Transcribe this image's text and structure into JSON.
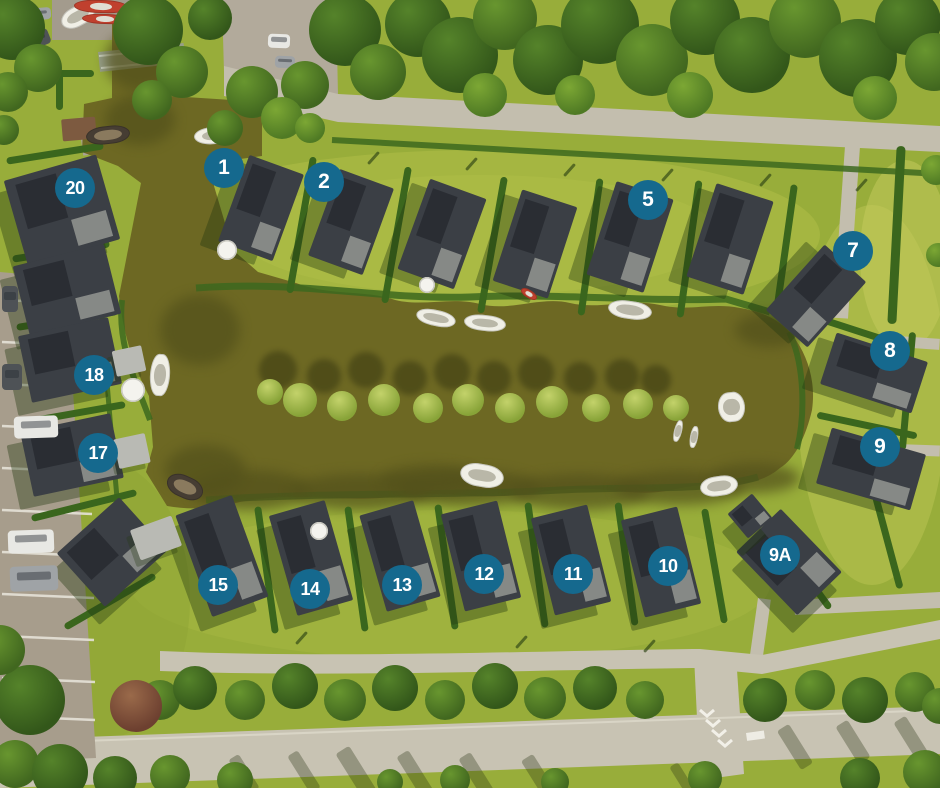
{
  "colors": {
    "marker_bg": "#15698e",
    "marker_text": "#ffffff",
    "water": "#6d6823",
    "grass": "#98ad3a",
    "road": "#c3beae",
    "road_light": "#c8c3b3",
    "parking": "#a79d8c",
    "roof": "#3b3f45",
    "roof_panel": "#2a2d33",
    "roof_light": "#8f918d",
    "hedge": "#3a661d",
    "boat_white": "#f0efe6",
    "shadow_olive": "#53511b"
  },
  "markers": [
    {
      "label": "1",
      "x": 224,
      "y": 168
    },
    {
      "label": "2",
      "x": 324,
      "y": 182
    },
    {
      "label": "5",
      "x": 648,
      "y": 200
    },
    {
      "label": "7",
      "x": 853,
      "y": 251
    },
    {
      "label": "8",
      "x": 890,
      "y": 351
    },
    {
      "label": "9",
      "x": 880,
      "y": 447
    },
    {
      "label": "9A",
      "x": 780,
      "y": 555
    },
    {
      "label": "10",
      "x": 668,
      "y": 566
    },
    {
      "label": "11",
      "x": 573,
      "y": 574
    },
    {
      "label": "12",
      "x": 484,
      "y": 574
    },
    {
      "label": "13",
      "x": 402,
      "y": 585
    },
    {
      "label": "14",
      "x": 310,
      "y": 589
    },
    {
      "label": "15",
      "x": 218,
      "y": 585
    },
    {
      "label": "17",
      "x": 98,
      "y": 453
    },
    {
      "label": "18",
      "x": 94,
      "y": 375
    },
    {
      "label": "20",
      "x": 75,
      "y": 188
    }
  ],
  "scene": {
    "houses": [
      [
        232,
        162,
        58,
        92,
        20
      ],
      [
        322,
        176,
        58,
        92,
        20
      ],
      [
        412,
        186,
        60,
        96,
        20
      ],
      [
        506,
        196,
        58,
        96,
        18
      ],
      [
        600,
        188,
        60,
        98,
        18
      ],
      [
        700,
        190,
        60,
        98,
        18
      ],
      [
        788,
        252,
        56,
        88,
        42
      ],
      [
        826,
        346,
        96,
        54,
        18
      ],
      [
        822,
        440,
        98,
        58,
        16
      ],
      [
        758,
        518,
        62,
        88,
        -44
      ],
      [
        734,
        500,
        32,
        32,
        -40
      ],
      [
        632,
        512,
        58,
        100,
        -14
      ],
      [
        542,
        510,
        58,
        100,
        -14
      ],
      [
        452,
        506,
        58,
        100,
        -14
      ],
      [
        372,
        506,
        56,
        100,
        -16
      ],
      [
        282,
        506,
        58,
        104,
        -16
      ],
      [
        192,
        502,
        60,
        108,
        -20
      ],
      [
        14,
        166,
        96,
        88,
        -16
      ],
      [
        20,
        254,
        94,
        72,
        -14
      ],
      [
        24,
        326,
        92,
        68,
        -12
      ],
      [
        26,
        422,
        92,
        66,
        -12
      ],
      [
        70,
        516,
        84,
        72,
        -42
      ]
    ],
    "sheds": [
      [
        116,
        436,
        32,
        30,
        -12
      ],
      [
        114,
        348,
        30,
        26,
        -12
      ],
      [
        134,
        522,
        44,
        32,
        -20
      ],
      [
        62,
        118,
        34,
        22,
        -5,
        "garden"
      ]
    ],
    "hedges": [
      [
        298,
        156,
        7,
        138,
        10
      ],
      [
        393,
        166,
        7,
        138,
        10
      ],
      [
        489,
        176,
        7,
        138,
        10
      ],
      [
        587,
        178,
        7,
        138,
        8
      ],
      [
        686,
        180,
        7,
        138,
        8
      ],
      [
        782,
        184,
        7,
        128,
        8
      ],
      [
        263,
        506,
        7,
        128,
        -8
      ],
      [
        353,
        506,
        7,
        126,
        -8
      ],
      [
        443,
        504,
        7,
        126,
        -8
      ],
      [
        533,
        502,
        7,
        126,
        -8
      ],
      [
        623,
        502,
        7,
        124,
        -8
      ],
      [
        711,
        508,
        7,
        116,
        -10
      ],
      [
        797,
        518,
        7,
        100,
        -36
      ],
      [
        6,
        150,
        98,
        7,
        -9
      ],
      [
        12,
        248,
        98,
        7,
        -9
      ],
      [
        16,
        316,
        102,
        7,
        -9
      ],
      [
        22,
        410,
        104,
        7,
        -10
      ],
      [
        30,
        502,
        108,
        7,
        -14
      ],
      [
        58,
        598,
        104,
        7,
        -30
      ],
      [
        810,
        328,
        98,
        7,
        18
      ],
      [
        816,
        422,
        102,
        7,
        12
      ],
      [
        892,
        146,
        9,
        178,
        3
      ],
      [
        904,
        332,
        7,
        118,
        5
      ],
      [
        884,
        492,
        7,
        98,
        -15
      ],
      [
        56,
        70,
        38,
        7,
        0
      ],
      [
        56,
        70,
        7,
        40,
        0
      ]
    ],
    "lamps": [
      [
        372,
        150,
        3,
        16,
        42
      ],
      [
        470,
        156,
        3,
        16,
        42
      ],
      [
        568,
        162,
        3,
        16,
        42
      ],
      [
        666,
        167,
        3,
        16,
        42
      ],
      [
        764,
        172,
        3,
        16,
        42
      ],
      [
        860,
        177,
        3,
        16,
        42
      ],
      [
        300,
        630,
        3,
        16,
        42
      ],
      [
        520,
        634,
        3,
        16,
        42
      ],
      [
        648,
        638,
        3,
        16,
        42
      ]
    ],
    "road_shadows": [
      [
        348,
        746,
        16,
        52,
        -32
      ],
      [
        408,
        750,
        14,
        48,
        -32
      ],
      [
        470,
        752,
        14,
        48,
        -32
      ],
      [
        532,
        754,
        14,
        46,
        -32
      ],
      [
        298,
        750,
        12,
        44,
        -32
      ],
      [
        788,
        724,
        14,
        46,
        -32
      ],
      [
        846,
        720,
        14,
        44,
        -32
      ],
      [
        904,
        716,
        14,
        44,
        -32
      ],
      [
        238,
        754,
        12,
        40,
        -32
      ],
      [
        678,
        762,
        10,
        36,
        -32
      ]
    ],
    "water_fx": [
      [
        190,
        470,
        120,
        40,
        0,
        "wsh"
      ],
      [
        290,
        474,
        140,
        36,
        0,
        "wsh"
      ],
      [
        400,
        470,
        140,
        36,
        0,
        "wsh"
      ],
      [
        510,
        474,
        140,
        36,
        0,
        "wsh"
      ],
      [
        615,
        471,
        130,
        34,
        0,
        "wsh"
      ],
      [
        710,
        463,
        90,
        30,
        0,
        "wsh"
      ],
      [
        165,
        445,
        80,
        50,
        0,
        "wsh"
      ],
      [
        160,
        295,
        80,
        70,
        0,
        "wsh"
      ],
      [
        735,
        313,
        70,
        34,
        0,
        "wsh"
      ],
      [
        105,
        95,
        70,
        50,
        0,
        "wsh"
      ],
      [
        105,
        30,
        70,
        60,
        0,
        "wsh"
      ],
      [
        380,
        465,
        100,
        30,
        0,
        "wsh"
      ],
      [
        259,
        351,
        38,
        38,
        0,
        "tsh"
      ],
      [
        307,
        359,
        34,
        34,
        0,
        "tsh"
      ],
      [
        348,
        352,
        36,
        36,
        0,
        "tsh"
      ],
      [
        393,
        361,
        34,
        34,
        0,
        "tsh"
      ],
      [
        434,
        354,
        36,
        36,
        0,
        "tsh"
      ],
      [
        477,
        361,
        34,
        34,
        0,
        "tsh"
      ],
      [
        518,
        355,
        36,
        36,
        0,
        "tsh"
      ],
      [
        564,
        362,
        32,
        32,
        0,
        "tsh"
      ],
      [
        605,
        359,
        34,
        34,
        0,
        "tsh"
      ],
      [
        641,
        365,
        30,
        30,
        0,
        "tsh"
      ],
      [
        257,
        379,
        26,
        26,
        0,
        "ti"
      ],
      [
        283,
        383,
        34,
        34,
        0,
        "ti"
      ],
      [
        327,
        391,
        30,
        30,
        0,
        "ti"
      ],
      [
        368,
        384,
        32,
        32,
        0,
        "ti"
      ],
      [
        413,
        393,
        30,
        30,
        0,
        "ti"
      ],
      [
        452,
        384,
        32,
        32,
        0,
        "ti"
      ],
      [
        495,
        393,
        30,
        30,
        0,
        "ti"
      ],
      [
        536,
        386,
        32,
        32,
        0,
        "ti"
      ],
      [
        582,
        394,
        28,
        28,
        0,
        "ti"
      ],
      [
        623,
        389,
        30,
        30,
        0,
        "ti"
      ],
      [
        663,
        395,
        26,
        26,
        0,
        "ti"
      ]
    ],
    "boats": [
      [
        60,
        6,
        36,
        20,
        -28,
        "white"
      ],
      [
        194,
        127,
        42,
        17,
        -4,
        "white"
      ],
      [
        416,
        310,
        40,
        16,
        12,
        "white"
      ],
      [
        464,
        315,
        42,
        16,
        6,
        "white"
      ],
      [
        608,
        301,
        44,
        18,
        8,
        "white"
      ],
      [
        718,
        392,
        27,
        30,
        -6,
        "white"
      ],
      [
        150,
        354,
        20,
        42,
        4,
        "white"
      ],
      [
        460,
        464,
        44,
        23,
        10,
        "white"
      ],
      [
        700,
        476,
        38,
        20,
        -8,
        "white"
      ],
      [
        86,
        126,
        44,
        18,
        -6,
        "dark"
      ],
      [
        166,
        476,
        38,
        22,
        24,
        "dark"
      ],
      [
        74,
        0,
        54,
        13,
        2,
        "red"
      ],
      [
        82,
        14,
        46,
        10,
        2,
        "red"
      ],
      [
        520,
        290,
        18,
        8,
        32,
        "red"
      ],
      [
        674,
        420,
        8,
        22,
        14,
        "white"
      ],
      [
        690,
        426,
        8,
        22,
        10,
        "white"
      ]
    ],
    "cars": [
      [
        22,
        32,
        28,
        16,
        -22,
        "dark"
      ],
      [
        25,
        8,
        26,
        12,
        -5,
        "gray"
      ],
      [
        268,
        34,
        22,
        14,
        2,
        "white"
      ],
      [
        275,
        56,
        20,
        12,
        2,
        "gray"
      ],
      [
        2,
        286,
        16,
        26,
        0,
        "dark"
      ],
      [
        2,
        364,
        20,
        26,
        0,
        "dark"
      ],
      [
        14,
        416,
        44,
        22,
        -2,
        "white"
      ],
      [
        8,
        530,
        46,
        23,
        -2,
        "white"
      ],
      [
        10,
        566,
        48,
        25,
        -2,
        "gray"
      ]
    ],
    "umbrellas": [
      [
        121,
        378,
        24,
        24
      ],
      [
        217,
        240,
        20,
        20
      ],
      [
        310,
        522,
        18,
        18
      ],
      [
        419,
        277,
        16,
        16
      ]
    ],
    "trees": [
      [
        -20,
        -5,
        65,
        65,
        0,
        "t1"
      ],
      [
        14,
        44,
        48,
        48,
        0,
        "t2"
      ],
      [
        -12,
        72,
        40,
        40,
        0,
        "t2"
      ],
      [
        113,
        -5,
        70,
        70,
        0,
        "t1"
      ],
      [
        156,
        46,
        52,
        52,
        0,
        "t2"
      ],
      [
        188,
        -4,
        44,
        44,
        0,
        "t1"
      ],
      [
        132,
        80,
        40,
        40,
        0,
        "t2"
      ],
      [
        309,
        -6,
        72,
        72,
        0,
        "t1"
      ],
      [
        281,
        61,
        48,
        48,
        0,
        "t2"
      ],
      [
        350,
        44,
        56,
        56,
        0,
        "t2"
      ],
      [
        385,
        -9,
        66,
        66,
        0,
        "t1"
      ],
      [
        422,
        17,
        76,
        76,
        0,
        "t1"
      ],
      [
        473,
        -14,
        64,
        64,
        0,
        "t2"
      ],
      [
        513,
        25,
        70,
        70,
        0,
        "t1"
      ],
      [
        561,
        -14,
        78,
        78,
        0,
        "t1"
      ],
      [
        616,
        24,
        72,
        72,
        0,
        "t2"
      ],
      [
        670,
        -15,
        70,
        70,
        0,
        "t1"
      ],
      [
        714,
        17,
        76,
        76,
        0,
        "t1"
      ],
      [
        769,
        -14,
        72,
        72,
        0,
        "t2"
      ],
      [
        819,
        19,
        78,
        78,
        0,
        "t1"
      ],
      [
        875,
        -11,
        66,
        66,
        0,
        "t1"
      ],
      [
        905,
        33,
        58,
        58,
        0,
        "t2"
      ],
      [
        463,
        73,
        44,
        44,
        0,
        "t3"
      ],
      [
        667,
        72,
        46,
        46,
        0,
        "t3"
      ],
      [
        853,
        76,
        44,
        44,
        0,
        "t3"
      ],
      [
        555,
        75,
        40,
        40,
        0,
        "t3"
      ],
      [
        226,
        66,
        52,
        52,
        0,
        "t2"
      ],
      [
        261,
        97,
        42,
        42,
        0,
        "t3"
      ],
      [
        207,
        110,
        36,
        36,
        0,
        "t2"
      ],
      [
        295,
        113,
        30,
        30,
        0,
        "t3"
      ],
      [
        -11,
        115,
        30,
        30,
        0,
        "t2"
      ],
      [
        921,
        155,
        30,
        30,
        0,
        "t3"
      ],
      [
        926,
        243,
        24,
        24,
        0,
        "t3"
      ],
      [
        140,
        680,
        40,
        40,
        0,
        "t2"
      ],
      [
        173,
        666,
        44,
        44,
        0,
        "t1"
      ],
      [
        225,
        680,
        40,
        40,
        0,
        "t2"
      ],
      [
        272,
        663,
        46,
        46,
        0,
        "t1"
      ],
      [
        324,
        679,
        42,
        42,
        0,
        "t2"
      ],
      [
        372,
        665,
        46,
        46,
        0,
        "t1"
      ],
      [
        425,
        680,
        40,
        40,
        0,
        "t2"
      ],
      [
        472,
        663,
        46,
        46,
        0,
        "t1"
      ],
      [
        524,
        677,
        42,
        42,
        0,
        "t2"
      ],
      [
        573,
        666,
        44,
        44,
        0,
        "t1"
      ],
      [
        626,
        681,
        38,
        38,
        0,
        "t2"
      ],
      [
        743,
        678,
        44,
        44,
        0,
        "t1"
      ],
      [
        795,
        670,
        40,
        40,
        0,
        "t2"
      ],
      [
        842,
        677,
        46,
        46,
        0,
        "t1"
      ],
      [
        895,
        672,
        40,
        40,
        0,
        "t2"
      ],
      [
        922,
        688,
        36,
        36,
        0,
        "t2"
      ],
      [
        -9,
        740,
        48,
        48,
        0,
        "t2"
      ],
      [
        32,
        744,
        56,
        56,
        0,
        "t1"
      ],
      [
        93,
        756,
        44,
        44,
        0,
        "t1"
      ],
      [
        150,
        755,
        40,
        40,
        0,
        "t2"
      ],
      [
        217,
        762,
        36,
        36,
        0,
        "t2"
      ],
      [
        377,
        769,
        26,
        26,
        0,
        "t2"
      ],
      [
        440,
        765,
        30,
        30,
        0,
        "t2"
      ],
      [
        541,
        768,
        28,
        28,
        0,
        "t2"
      ],
      [
        688,
        761,
        34,
        34,
        0,
        "t2"
      ],
      [
        840,
        758,
        40,
        40,
        0,
        "t1"
      ],
      [
        903,
        750,
        44,
        44,
        0,
        "t2"
      ],
      [
        -5,
        665,
        70,
        70,
        0,
        "t1"
      ],
      [
        -25,
        625,
        50,
        50,
        0,
        "t2"
      ],
      [
        110,
        680,
        52,
        52,
        0,
        "tr"
      ]
    ]
  }
}
